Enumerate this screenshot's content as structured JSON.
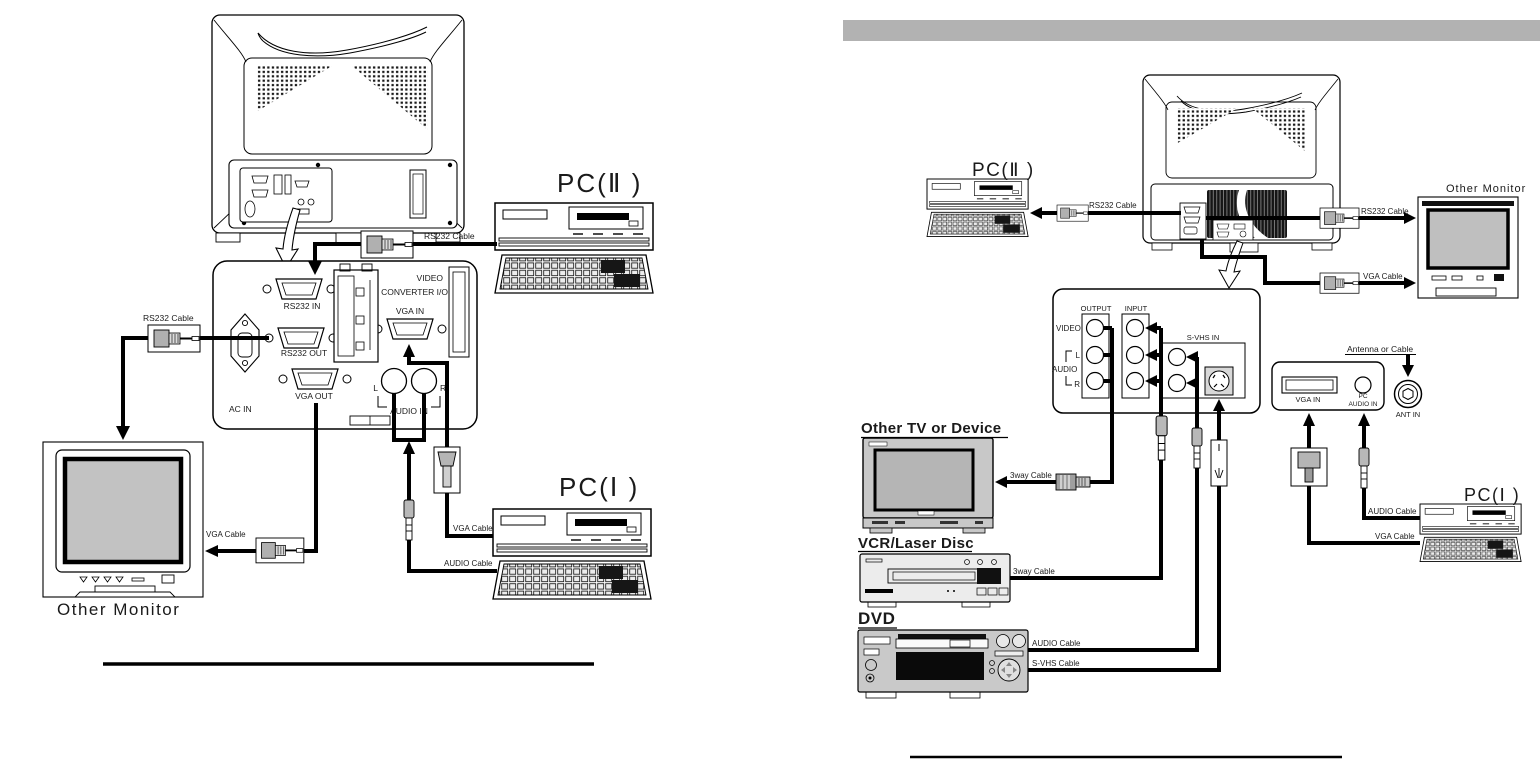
{
  "page": {
    "background": "#ffffff",
    "top_bar_color": "#b2b2b2"
  },
  "left": {
    "pc2_label": "PC(Ⅱ )",
    "pc1_label": "PC(Ⅰ )",
    "other_monitor_label": "Other Monitor",
    "cables": {
      "rs232_pc2": "RS232 Cable",
      "rs232_monitor": "RS232 Cable",
      "vga_monitor": "VGA Cable",
      "vga_pc1": "VGA Cable",
      "audio_pc1": "AUDIO Cable"
    },
    "panel": {
      "rs232_in": "RS232 IN",
      "rs232_out": "RS232 OUT",
      "vga_out": "VGA OUT",
      "ac_in": "AC IN",
      "video": "VIDEO",
      "converter_io": "CONVERTER I/O",
      "vga_in": "VGA IN",
      "left": "L",
      "right": "R",
      "audio_in": "AUDIO IN"
    }
  },
  "right": {
    "pc2_label": "PC(Ⅱ )",
    "pc1_label": "PC(Ⅰ )",
    "other_monitor_label": "Other Monitor",
    "other_tv_label": "Other TV or Device",
    "vcr_label": "VCR/Laser Disc",
    "dvd_label": "DVD",
    "cables": {
      "rs232_pc2": "RS232 Cable",
      "rs232_monitor": "RS232 Cable",
      "vga_monitor": "VGA Cable",
      "threeway_tv": "3way Cable",
      "threeway_vcr": "3way Cable",
      "audio_dvd": "AUDIO Cable",
      "svhs_dvd": "S-VHS Cable",
      "audio_pc1": "AUDIO Cable",
      "vga_pc1": "VGA Cable",
      "antenna": "Antenna or Cable"
    },
    "av_panel": {
      "output": "OUTPUT",
      "input": "INPUT",
      "video": "VIDEO",
      "audio": "AUDIO",
      "left": "L",
      "right": "R",
      "svhs_in": "S-VHS IN"
    },
    "pc_panel": {
      "vga_in": "VGA IN",
      "pc": "PC",
      "audio_in": "AUDIO IN",
      "ant_in": "ANT IN"
    }
  }
}
